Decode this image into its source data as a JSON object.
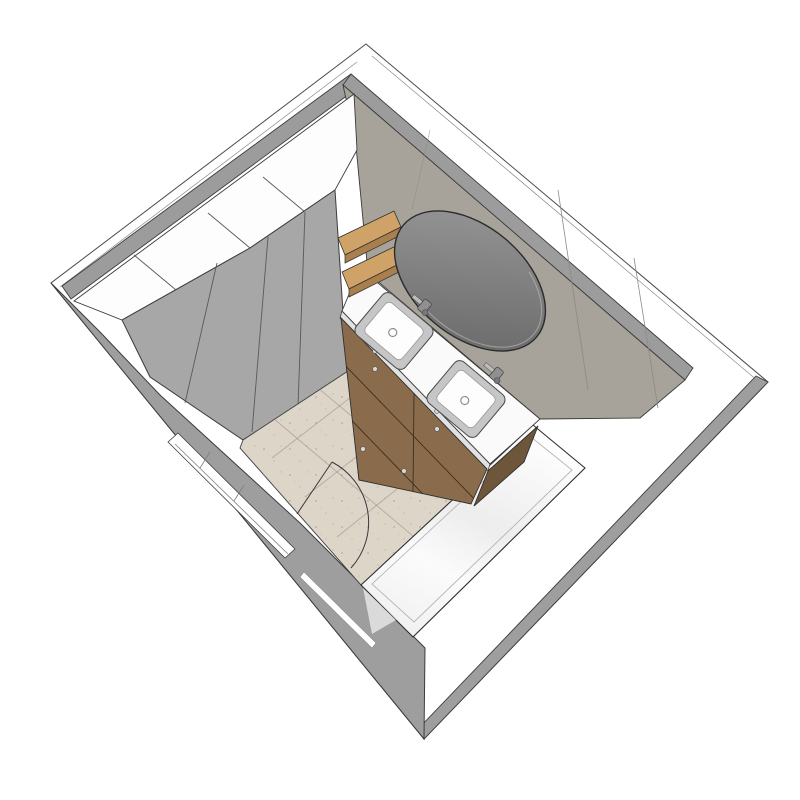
{
  "scene": {
    "title": "3D bathroom plan render",
    "view": "axonometric top view, white background, SketchUp-style line render"
  },
  "colors": {
    "bg": "#ffffff",
    "outline": "#4a4a4a",
    "wallTopStrip": "#9c9c9c",
    "extWall": "#9e9e9e",
    "extWallDark": "#969696",
    "wardrobeFront": "#a7a7a7",
    "wardrobeTop": "#fdfdfd",
    "taupeWall": "#a7a29a",
    "mirrorLight": "#929292",
    "mirrorDark": "#6a6a6a",
    "floor": "#dcd5c8",
    "floorLine": "#bdb4a4",
    "speckle": "#b1a28b",
    "counter": "#fafafa",
    "counterEdge": "#e2e2e2",
    "woodFront": "#8a6c4d",
    "woodSide": "#6e563b",
    "shelfTop": "#cfa368",
    "shelfEdge": "#a87f4d",
    "sinkRim": "#c6c6c6",
    "basin": "#fdfdfd",
    "chrome": "#909090",
    "chromeLight": "#bcbcbc",
    "tub": "#ffffff",
    "tubShade": "#e9e9e9",
    "knob": "#d8d8d8"
  },
  "objects": [
    {
      "id": "outer-walls",
      "label": "Exterior walls (white tops)"
    },
    {
      "id": "wardrobe",
      "label": "Tall wardrobe, 4 grey doors, white top"
    },
    {
      "id": "shelves",
      "label": "Two oak wall shelves"
    },
    {
      "id": "mirror",
      "label": "Round wall mirror"
    },
    {
      "id": "vanity",
      "label": "Double vanity, wood drawers, white counter"
    },
    {
      "id": "sink-left",
      "label": "Left sink with chrome tap"
    },
    {
      "id": "sink-right",
      "label": "Right sink with chrome tap"
    },
    {
      "id": "bathtub",
      "label": "Built-in bathtub"
    },
    {
      "id": "door",
      "label": "Door opening with swing arc"
    },
    {
      "id": "floor",
      "label": "Beige travertine tile floor"
    }
  ]
}
